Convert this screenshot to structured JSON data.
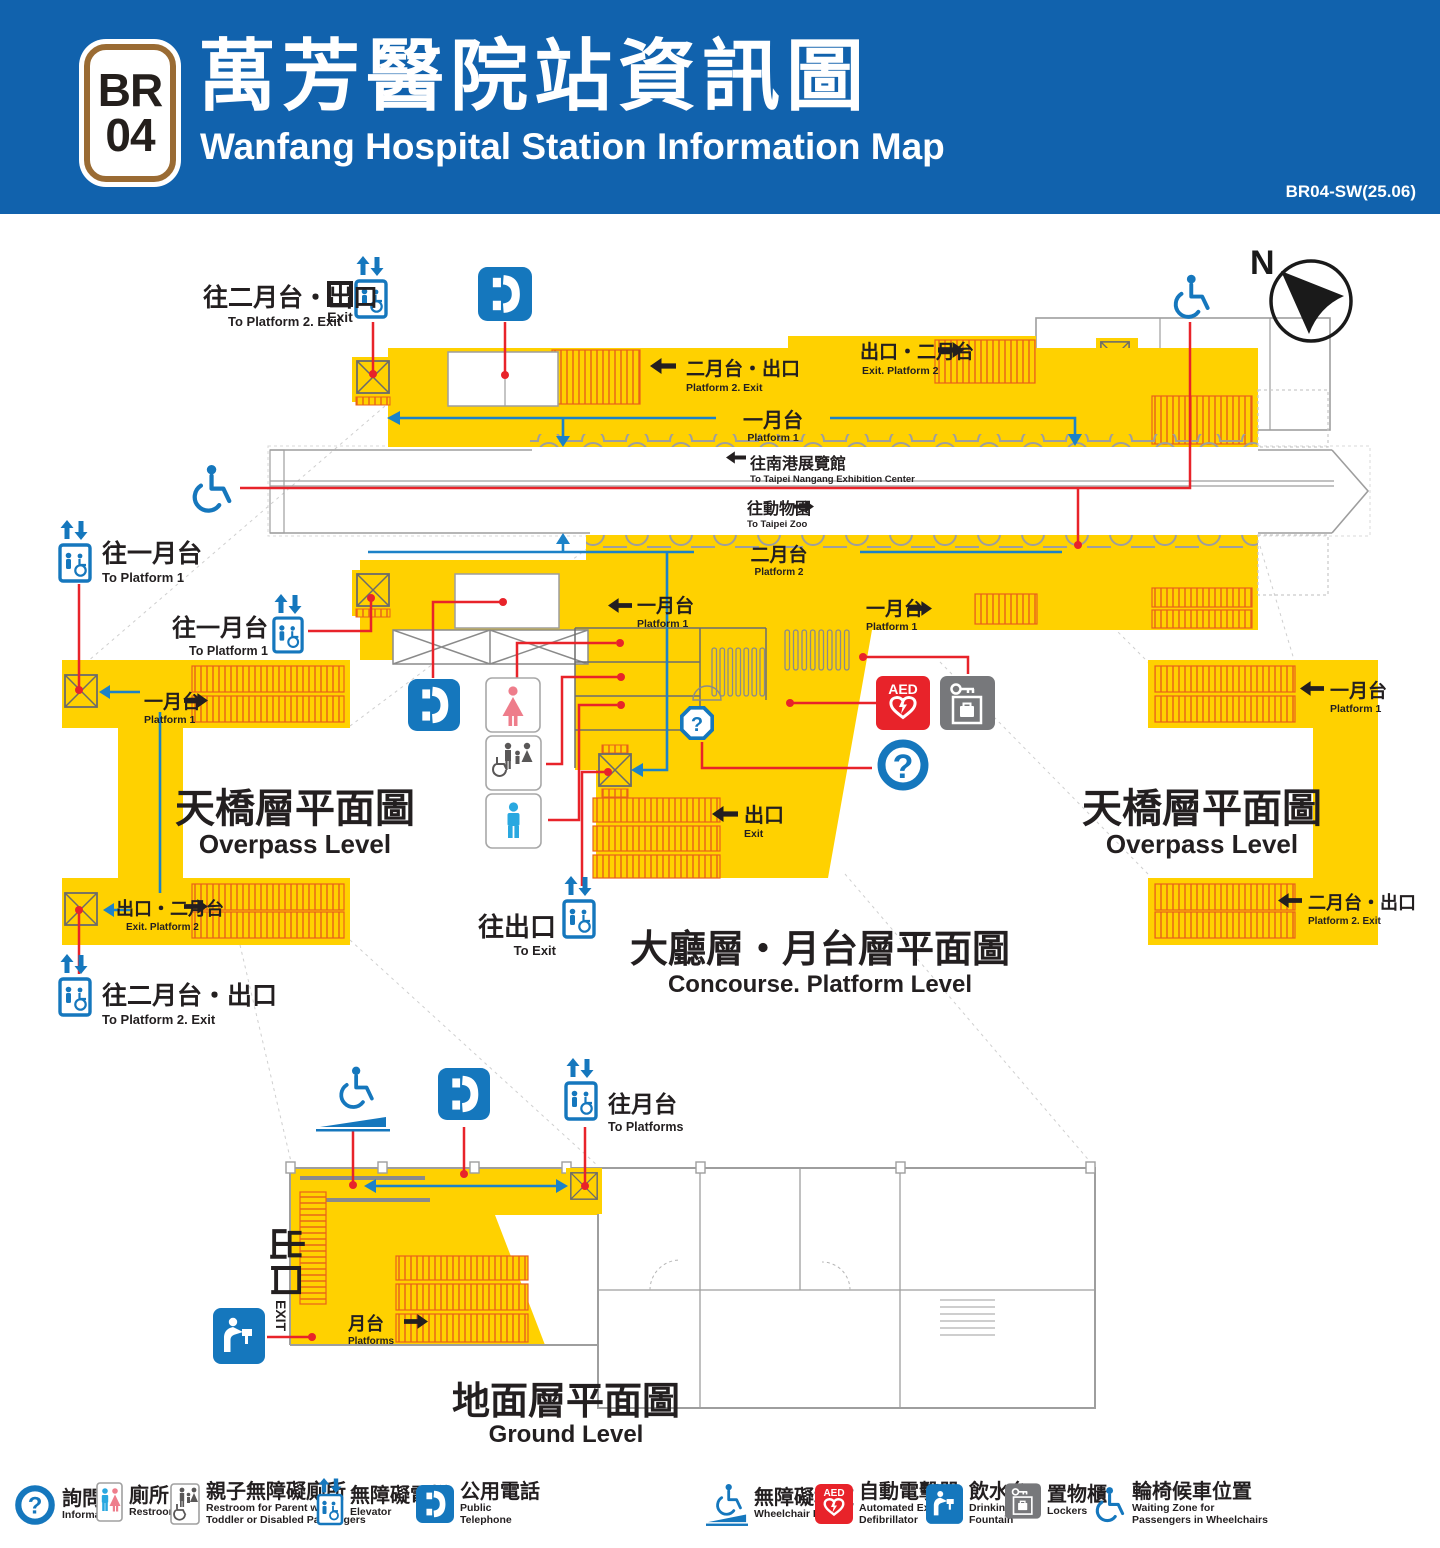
{
  "header": {
    "line_code": "BR",
    "station_code": "04",
    "title_zh": "萬芳醫院站資訊圖",
    "title_en": "Wanfang Hospital Station Information Map",
    "version": "BR04-SW(25.06)"
  },
  "compass": {
    "north": "N"
  },
  "glyphs": {
    "question_mark": "?",
    "aed": "AED"
  },
  "titles": {
    "overpass": {
      "zh": "天橋層平面圖",
      "en": "Overpass Level"
    },
    "concourse": {
      "zh": "大廳層・月台層平面圖",
      "en": "Concourse. Platform Level"
    },
    "ground": {
      "zh": "地面層平面圖",
      "en": "Ground Level"
    }
  },
  "labels": {
    "to_platform2_exit": {
      "zh": "往二月台・出口",
      "en": "To Platform 2. Exit"
    },
    "to_platform1": {
      "zh": "往一月台",
      "en": "To Platform 1"
    },
    "platform2_exit": {
      "zh": "二月台・出口",
      "en": "Platform 2. Exit"
    },
    "exit_platform2": {
      "zh": "出口・二月台",
      "en": "Exit. Platform 2"
    },
    "platform1": {
      "zh": "一月台",
      "en": "Platform 1"
    },
    "platform2": {
      "zh": "二月台",
      "en": "Platform 2"
    },
    "to_nangang": {
      "zh": "往南港展覽館",
      "en": "To Taipei Nangang Exhibition Center"
    },
    "to_zoo": {
      "zh": "往動物園",
      "en": "To Taipei Zoo"
    },
    "exit": {
      "zh": "出口",
      "en": "Exit"
    },
    "exit_marker": {
      "en": "Exit"
    },
    "to_exit": {
      "zh": "往出口",
      "en": "To Exit"
    },
    "to_platforms": {
      "zh": "往月台",
      "en": "To Platforms"
    },
    "platforms": {
      "zh": "月台",
      "en": "Platforms"
    },
    "ground_exit": {
      "zh": "出口",
      "en": "EXIT"
    }
  },
  "legend": {
    "items": [
      {
        "icon": "information-icon",
        "zh": "詢問處",
        "en1": "Information",
        "en2": ""
      },
      {
        "icon": "restroom-icon",
        "zh": "廁所",
        "en1": "Restroom",
        "en2": ""
      },
      {
        "icon": "accessible-family-restroom-icon",
        "zh": "親子無障礙廁所",
        "en1": "Restroom for Parent with",
        "en2": "Toddler or Disabled Passengers"
      },
      {
        "icon": "elevator-icon",
        "zh": "無障礙電梯",
        "en1": "Elevator",
        "en2": ""
      },
      {
        "icon": "public-telephone-icon",
        "zh": "公用電話",
        "en1": "Public",
        "en2": "Telephone"
      },
      {
        "icon": "wheelchair-ramp-icon",
        "zh": "無障礙坡道",
        "en1": "Wheelchair Ramp",
        "en2": ""
      },
      {
        "icon": "aed-icon",
        "zh": "自動電擊器",
        "en1": "Automated External",
        "en2": "Defibrillator"
      },
      {
        "icon": "drinking-fountain-icon",
        "zh": "飲水台",
        "en1": "Drinking",
        "en2": "Fountain"
      },
      {
        "icon": "lockers-icon",
        "zh": "置物櫃",
        "en1": "Lockers",
        "en2": ""
      },
      {
        "icon": "wheelchair-waiting-icon",
        "zh": "輪椅候車位置",
        "en1": "Waiting Zone for",
        "en2": "Passengers in Wheelchairs"
      }
    ]
  },
  "colors": {
    "header_blue": "#1162ad",
    "line_brown": "#9a6b33",
    "floor_yellow": "#ffd100",
    "stair_orange": "#e8611a",
    "connector_red": "#e8232a",
    "metro_blue": "#1577bd",
    "flow_blue": "#1c82c8",
    "wall_gray": "#9e9e9e",
    "text_dark": "#231f20",
    "locker_gray": "#77787b",
    "female_pink": "#ee7d8b",
    "male_blue": "#29a8e0",
    "figure_gray": "#595757"
  }
}
